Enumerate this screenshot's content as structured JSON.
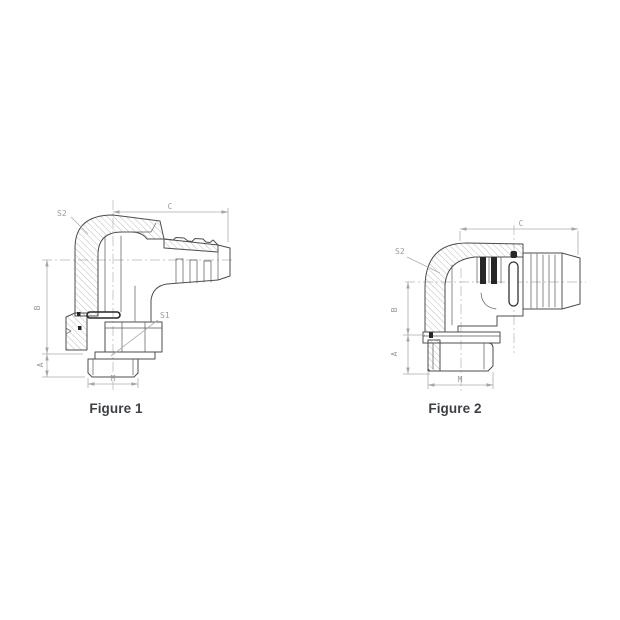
{
  "page": {
    "background": "#ffffff"
  },
  "colors": {
    "line": "#4d4d4d",
    "hatch": "#909090",
    "dimension": "#adadad",
    "label_text": "#9b9b9b",
    "caption_text": "#3d4147",
    "dark_fill": "#262626"
  },
  "figure1": {
    "caption": "Figure 1",
    "labels": {
      "s2": "S2",
      "c": "C",
      "b": "B",
      "a": "A",
      "m": "M",
      "s1": "S1"
    }
  },
  "figure2": {
    "caption": "Figure 2",
    "labels": {
      "s2": "S2",
      "c": "C",
      "b": "B",
      "a": "A",
      "m": "M"
    }
  }
}
